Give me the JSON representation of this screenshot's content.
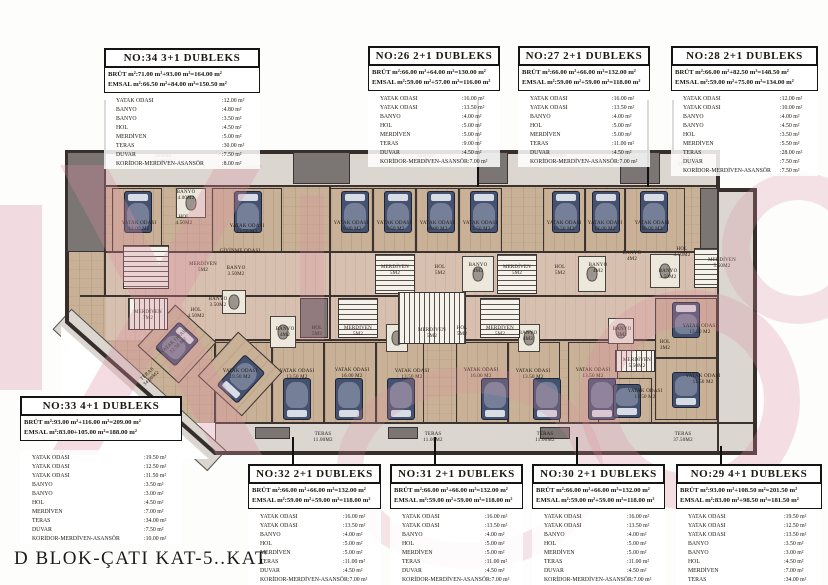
{
  "title": "D BLOK-ÇATI KAT-5..KAT",
  "accent_colors": {
    "walls": "#362e2b",
    "floor": "#c9b197",
    "terrace": "#dbd7d0",
    "watermark": "#dc8ea1",
    "bed": "#44516f"
  },
  "units": [
    {
      "id": "no34",
      "header": "NO:34 3+1 DUBLEKS",
      "brut": "BRÜT m²:71.00 m²+93.00 m²=164.00 m²",
      "emsal": "EMSAL m²:66.50 m²+84.00 m²=150.50 m²",
      "rooms": [
        [
          "YATAK ODASI",
          ":12.00 m²"
        ],
        [
          "BANYO",
          ":4.80 m²"
        ],
        [
          "BANYO",
          ":3.50 m²"
        ],
        [
          "HOL",
          ":4.50 m²"
        ],
        [
          "MERDİVEN",
          ":5.00 m²"
        ],
        [
          "TERAS",
          ":30.00 m²"
        ],
        [
          "DUVAR",
          ":7.50 m²"
        ],
        [
          "KORİDOR-MERDİVEN-ASANSÖR",
          ":8.00 m²"
        ]
      ]
    },
    {
      "id": "no26",
      "header": "NO:26 2+1 DUBLEKS",
      "brut": "BRÜT m²:66.00 m²+64.00 m²=130.00 m²",
      "emsal": "EMSAL m²:59.00 m²+57.00 m²=116.00 m²",
      "rooms": [
        [
          "YATAK ODASI",
          ":16.00 m²"
        ],
        [
          "YATAK ODASI",
          ":13.50 m²"
        ],
        [
          "BANYO",
          ":4.00 m²"
        ],
        [
          "HOL",
          ":5.00 m²"
        ],
        [
          "MERDİVEN",
          ":5.00 m²"
        ],
        [
          "TERAS",
          ":9.00 m²"
        ],
        [
          "DUVAR",
          ":4.50 m²"
        ],
        [
          "KORİDOR-MERDİVEN-ASANSÖR",
          ":7.00 m²"
        ]
      ]
    },
    {
      "id": "no27",
      "header": "NO:27 2+1 DUBLEKS",
      "brut": "BRÜT m²:66.00 m²+66.00 m²=132.00 m²",
      "emsal": "EMSAL m²:59.00 m²+59.00 m²=118.00 m²",
      "rooms": [
        [
          "YATAK ODASI",
          ":16.00 m²"
        ],
        [
          "YATAK ODASI",
          ":13.50 m²"
        ],
        [
          "BANYO",
          ":4.00 m²"
        ],
        [
          "HOL",
          ":5.00 m²"
        ],
        [
          "MERDİVEN",
          ":5.00 m²"
        ],
        [
          "TERAS",
          ":11.00 m²"
        ],
        [
          "DUVAR",
          ":4.50 m²"
        ],
        [
          "KORİDOR-MERDİVEN-ASANSÖR",
          ":7.00 m²"
        ]
      ]
    },
    {
      "id": "no28",
      "header": "NO:28 2+1 DUBLEKS",
      "brut": "BRÜT m²:66.00 m²+82.50 m²=148.50 m²",
      "emsal": "EMSAL m²:59.00 m²+75.00 m²=134.00 m²",
      "rooms": [
        [
          "YATAK ODASI",
          ":12.00 m²"
        ],
        [
          "YATAK ODASI",
          ":10.00 m²"
        ],
        [
          "BANYO",
          ":4.00 m²"
        ],
        [
          "BANYO",
          ":4.50 m²"
        ],
        [
          "HOL",
          ":3.50 m²"
        ],
        [
          "MERDİVEN",
          ":5.50 m²"
        ],
        [
          "TERAS",
          ":28.00 m²"
        ],
        [
          "DUVAR",
          ":7.50 m²"
        ],
        [
          "KORİDOR-MERDİVEN-ASANSÖR",
          ":7.50 m²"
        ]
      ]
    },
    {
      "id": "no33",
      "header": "NO:33 4+1 DUBLEKS",
      "brut": "BRÜT m²:93.00 m²+116.00 m²=209.00 m²",
      "emsal": "EMSAL m²:83.00+105.00 m²=188.00 m²",
      "rooms": [
        [
          "YATAK ODASI",
          ":19.50 m²"
        ],
        [
          "YATAK ODASI",
          ":12.50 m²"
        ],
        [
          "YATAK ODASI",
          ":11.50 m²"
        ],
        [
          "BANYO",
          ":3.50 m²"
        ],
        [
          "BANYO",
          ":3.00 m²"
        ],
        [
          "HOL",
          ":4.50 m²"
        ],
        [
          "MERDİVEN",
          ":7.00 m²"
        ],
        [
          "TERAS",
          ":34.00 m²"
        ],
        [
          "DUVAR",
          ":7.50 m²"
        ],
        [
          "KORİDOR-MERDİVEN-ASANSÖR",
          ":10.00 m²"
        ]
      ]
    },
    {
      "id": "no32",
      "header": "NO:32 2+1 DUBLEKS",
      "brut": "BRÜT m²:66.00 m²+66.00 m²=132.00 m²",
      "emsal": "EMSAL m²:59.00 m²+59.00 m²=118.00 m²",
      "rooms": [
        [
          "YATAK ODASI",
          ":16.00 m²"
        ],
        [
          "YATAK ODASI",
          ":13.50 m²"
        ],
        [
          "BANYO",
          ":4.00 m²"
        ],
        [
          "HOL",
          ":5.00 m²"
        ],
        [
          "MERDİVEN",
          ":5.00 m²"
        ],
        [
          "TERAS",
          ":11.00 m²"
        ],
        [
          "DUVAR",
          ":4.50 m²"
        ],
        [
          "KORİDOR-MERDİVEN-ASANSÖR",
          ":7.00 m²"
        ]
      ]
    },
    {
      "id": "no31",
      "header": "NO:31 2+1 DUBLEKS",
      "brut": "BRÜT m²:66.00 m²+66.00 m²=132.00 m²",
      "emsal": "EMSAL m²:59.00 m²+59.00 m²=118.00 m²",
      "rooms": [
        [
          "YATAK ODASI",
          ":16.00 m²"
        ],
        [
          "YATAK ODASI",
          ":13.50 m²"
        ],
        [
          "BANYO",
          ":4.00 m²"
        ],
        [
          "HOL",
          ":5.00 m²"
        ],
        [
          "MERDİVEN",
          ":5.00 m²"
        ],
        [
          "TERAS",
          ":11.00 m²"
        ],
        [
          "DUVAR",
          ":4.50 m²"
        ],
        [
          "KORİDOR-MERDİVEN-ASANSÖR",
          ":7.00 m²"
        ]
      ]
    },
    {
      "id": "no30",
      "header": "NO:30 2+1 DUBLEKS",
      "brut": "BRÜT m²:66.00 m²+66.00 m²=132.00 m²",
      "emsal": "EMSAL m²:59.00 m²+59.00 m²=118.00 m²",
      "rooms": [
        [
          "YATAK ODASI",
          ":16.00 m²"
        ],
        [
          "YATAK ODASI",
          ":13.50 m²"
        ],
        [
          "BANYO",
          ":4.00 m²"
        ],
        [
          "HOL",
          ":5.00 m²"
        ],
        [
          "MERDİVEN",
          ":5.00 m²"
        ],
        [
          "TERAS",
          ":11.00 m²"
        ],
        [
          "DUVAR",
          ":4.50 m²"
        ],
        [
          "KORİDOR-MERDİVEN-ASANSÖR",
          ":7.00 m²"
        ]
      ]
    },
    {
      "id": "no29",
      "header": "NO:29 4+1 DUBLEKS",
      "brut": "BRÜT m²:93.00 m²+108.50 m²=201.50 m²",
      "emsal": "EMSAL m²:83.00 m²+98.50 m²=181.50 m²",
      "rooms": [
        [
          "YATAK ODASI",
          ":19.50 m²"
        ],
        [
          "YATAK ODASI",
          ":12.50 m²"
        ],
        [
          "YATAK ODASI",
          ":13.50 m²"
        ],
        [
          "BANYO",
          ":3.50 m²"
        ],
        [
          "BANYO",
          ":3.00 m²"
        ],
        [
          "HOL",
          ":4.50 m²"
        ],
        [
          "MERDİVEN",
          ":7.00 m²"
        ],
        [
          "TERAS",
          ":34.00 m²"
        ],
        [
          "DUVAR",
          ":7.50 m²"
        ],
        [
          "KORİDOR-MERDİVEN-ASANSÖR",
          ":10.00 m²"
        ]
      ]
    }
  ],
  "plan": {
    "labels": [
      {
        "x": 163,
        "y": 160,
        "t": "TERAS",
        "s": "30.00M2"
      },
      {
        "x": 425,
        "y": 160,
        "t": "TERAS",
        "s": "9.00M2"
      },
      {
        "x": 558,
        "y": 160,
        "t": "TERAS",
        "s": "11.00M2"
      },
      {
        "x": 688,
        "y": 162,
        "t": "TERAS",
        "s": "28.00M2"
      },
      {
        "x": 150,
        "y": 377,
        "t": "TERAS",
        "s": "34.00M2",
        "rot": -43
      },
      {
        "x": 323,
        "y": 438,
        "t": "TERAS",
        "s": "11.00M2"
      },
      {
        "x": 433,
        "y": 438,
        "t": "TERAS",
        "s": "11.00M2"
      },
      {
        "x": 545,
        "y": 438,
        "t": "TERAS",
        "s": "11.00M2"
      },
      {
        "x": 683,
        "y": 438,
        "t": "TERAS",
        "s": "37.50M2"
      },
      {
        "x": 139,
        "y": 227,
        "t": "YATAK ODASI",
        "s": "12.00 M2"
      },
      {
        "x": 247,
        "y": 230,
        "t": "YATAK ODASI",
        "s": "13.50 M2"
      },
      {
        "x": 351,
        "y": 227,
        "t": "YATAK ODASI",
        "s": "16.00 M2"
      },
      {
        "x": 394,
        "y": 227,
        "t": "YATAK ODASI",
        "s": "13.50 M2"
      },
      {
        "x": 437,
        "y": 227,
        "t": "YATAK ODASI",
        "s": "16.00 M2"
      },
      {
        "x": 480,
        "y": 227,
        "t": "YATAK ODASI",
        "s": "13.50 M2"
      },
      {
        "x": 564,
        "y": 227,
        "t": "YATAK ODASI",
        "s": "13.50 M2"
      },
      {
        "x": 605,
        "y": 227,
        "t": "YATAK ODASI",
        "s": "12.00 M2"
      },
      {
        "x": 652,
        "y": 227,
        "t": "YATAK ODASI",
        "s": "10.00 M2"
      },
      {
        "x": 186,
        "y": 196,
        "t": "BANYO",
        "s": "4.00M2"
      },
      {
        "x": 184,
        "y": 221,
        "t": "HOL",
        "s": "4.50M2"
      },
      {
        "x": 240,
        "y": 252,
        "t": "GİYİNME ODASI",
        "s": ""
      },
      {
        "x": 236,
        "y": 272,
        "t": "BANYO",
        "s": "3.50M2"
      },
      {
        "x": 203,
        "y": 268,
        "t": "MERDİVEN",
        "s": "5M2"
      },
      {
        "x": 395,
        "y": 271,
        "t": "MERDİVEN",
        "s": "5M2"
      },
      {
        "x": 440,
        "y": 271,
        "t": "HOL",
        "s": "5M2"
      },
      {
        "x": 478,
        "y": 269,
        "t": "BANYO",
        "s": "4M2"
      },
      {
        "x": 517,
        "y": 271,
        "t": "MERDİVEN",
        "s": "5M2"
      },
      {
        "x": 560,
        "y": 271,
        "t": "HOL",
        "s": "5M2"
      },
      {
        "x": 598,
        "y": 269,
        "t": "BANYO",
        "s": "4M2"
      },
      {
        "x": 632,
        "y": 257,
        "t": "BANYO",
        "s": "4M2"
      },
      {
        "x": 682,
        "y": 253,
        "t": "HOL",
        "s": "3.50M2"
      },
      {
        "x": 668,
        "y": 275,
        "t": "BANYO",
        "s": "4.50M2"
      },
      {
        "x": 722,
        "y": 264,
        "t": "MERDİVEN",
        "s": "5.50M2"
      },
      {
        "x": 148,
        "y": 316,
        "t": "MERDİVEN",
        "s": "7M2"
      },
      {
        "x": 196,
        "y": 314,
        "t": "HOL",
        "s": "4.50M2"
      },
      {
        "x": 218,
        "y": 303,
        "t": "BANYO",
        "s": "3.50M2"
      },
      {
        "x": 285,
        "y": 333,
        "t": "BANYO",
        "s": "4M2"
      },
      {
        "x": 317,
        "y": 332,
        "t": "HOL",
        "s": "5M2"
      },
      {
        "x": 358,
        "y": 332,
        "t": "MERDİVEN",
        "s": "5M2"
      },
      {
        "x": 432,
        "y": 334,
        "t": "MERDİVEN",
        "s": "5M2"
      },
      {
        "x": 462,
        "y": 332,
        "t": "HOL",
        "s": "5M2"
      },
      {
        "x": 500,
        "y": 332,
        "t": "MERDİVEN",
        "s": "5M2"
      },
      {
        "x": 528,
        "y": 337,
        "t": "BANYO",
        "s": "4M2"
      },
      {
        "x": 622,
        "y": 333,
        "t": "BANYO",
        "s": "3M2"
      },
      {
        "x": 665,
        "y": 346,
        "t": "HOL",
        "s": "3M2"
      },
      {
        "x": 637,
        "y": 364,
        "t": "MERDİVEN",
        "s": "5.50M2"
      },
      {
        "x": 240,
        "y": 375,
        "t": "YATAK ODASI",
        "s": "19.50 M2"
      },
      {
        "x": 177,
        "y": 344,
        "t": "YATAK ODASI",
        "s": "12.50 M2",
        "rot": -43
      },
      {
        "x": 297,
        "y": 375,
        "t": "YATAK ODASI",
        "s": "13.50 M2"
      },
      {
        "x": 352,
        "y": 374,
        "t": "YATAK ODASI",
        "s": "16.00 M2"
      },
      {
        "x": 412,
        "y": 375,
        "t": "YATAK ODASI",
        "s": "13.50 M2"
      },
      {
        "x": 481,
        "y": 374,
        "t": "YATAK ODASI",
        "s": "16.00 M2"
      },
      {
        "x": 533,
        "y": 375,
        "t": "YATAK ODASI",
        "s": "13.50 M2"
      },
      {
        "x": 593,
        "y": 374,
        "t": "YATAK ODASI",
        "s": "13.50 M2"
      },
      {
        "x": 700,
        "y": 330,
        "t": "YATAK ODASI",
        "s": "13.50 M2"
      },
      {
        "x": 703,
        "y": 380,
        "t": "YATAK ODASI",
        "s": "11.50 M2"
      },
      {
        "x": 645,
        "y": 395,
        "t": "YATAK ODASI",
        "s": "13.50 M2"
      }
    ]
  }
}
